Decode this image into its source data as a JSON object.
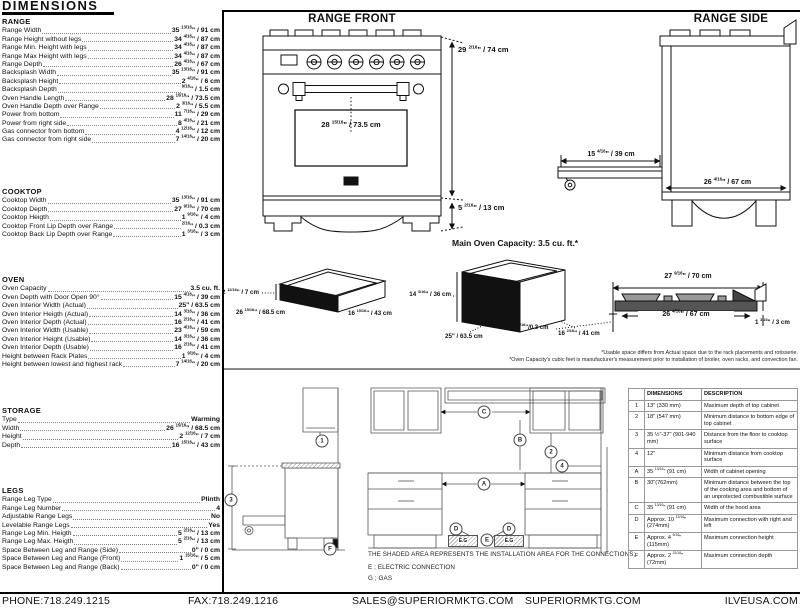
{
  "title": "DIMENSIONS",
  "sections": [
    {
      "id": "range",
      "header": "RANGE",
      "rows": [
        {
          "label": "Range Width",
          "value": "35 13/16\" / 91 cm"
        },
        {
          "label": "Range Height without legs",
          "value": "34 4/16\" / 87 cm"
        },
        {
          "label": "Range Min. Height with legs",
          "value": "34 4/16\" / 87 cm"
        },
        {
          "label": "Range Max Height with legs",
          "value": "34 4/16\" / 87 cm"
        },
        {
          "label": "Range Depth",
          "value": "26 4/16\" / 67 cm"
        },
        {
          "label": "Backsplash Width",
          "value": "35 13/16\" / 91 cm"
        },
        {
          "label": "Backsplash Height",
          "value": "2 4/16\" / 6 cm"
        },
        {
          "label": "Backsplash Depth",
          "value": "9/16\" / 1.5 cm"
        },
        {
          "label": "Oven Handle Length",
          "value": "28 15/16\" / 73.5 cm"
        },
        {
          "label": "Oven Handle Depth over Range",
          "value": "2 3/16\" / 5.5 cm"
        },
        {
          "label": "Power from bottom",
          "value": "11 7/16\" / 29 cm"
        },
        {
          "label": "Power from right side",
          "value": "8 4/16\" / 21 cm"
        },
        {
          "label": "Gas connector from bottom",
          "value": "4 12/16\" / 12 cm"
        },
        {
          "label": "Gas connector from right side",
          "value": "7 14/16\" / 20 cm"
        }
      ]
    },
    {
      "id": "cooktop",
      "header": "COOKTOP",
      "rows": [
        {
          "label": "Cooktop Width",
          "value": "35 13/16\" / 91 cm"
        },
        {
          "label": "Cooktop Depth",
          "value": "27 9/16\" / 70 cm"
        },
        {
          "label": "Cooktop Heigth",
          "value": "1 9/16\" / 4 cm"
        },
        {
          "label": "Cooktop Front Lip Depth over Range",
          "value": "2/16\" / 0.3 cm"
        },
        {
          "label": "Cooktop Back Lip Depth over Range",
          "value": "1 3/16\" / 3 cm"
        }
      ]
    },
    {
      "id": "oven",
      "header": "OVEN",
      "rows": [
        {
          "label": "Oven Capacity",
          "value": "3.5 cu. ft."
        },
        {
          "label": "Oven Depth with Door Open 90°",
          "value": "15 4/16\" / 39 cm"
        },
        {
          "label": "Oven Interior Width (Actual)",
          "value": "25\" / 63.5 cm"
        },
        {
          "label": "Oven Interior Heigth (Actual)",
          "value": "14 3/16\" / 36 cm"
        },
        {
          "label": "Oven Interior Depth (Actual)",
          "value": "16 2/16\" / 41 cm"
        },
        {
          "label": "Oven Interior Width (Usable)",
          "value": "23 4/16\" / 59 cm"
        },
        {
          "label": "Oven Interior Height (Usable)",
          "value": "14 3/16\" / 36 cm"
        },
        {
          "label": "Oven Interior Depth (Usable)",
          "value": "16 2/16\" / 41 cm"
        },
        {
          "label": "Height between Rack Plates",
          "value": "1 9/16\" / 4 cm"
        },
        {
          "label": "Height between lowest and highest rack",
          "value": "7 14/16\" / 20 cm"
        }
      ]
    },
    {
      "id": "storage",
      "header": "STORAGE",
      "rows": [
        {
          "label": "Type",
          "value": "Warming"
        },
        {
          "label": "Width",
          "value": "26 15/16\" / 68.5 cm"
        },
        {
          "label": "Height",
          "value": "2 12/16\" / 7 cm"
        },
        {
          "label": "Depth",
          "value": "16 15/16\" / 43 cm"
        }
      ]
    },
    {
      "id": "legs",
      "header": "LEGS",
      "rows": [
        {
          "label": "Range Leg Type",
          "value": "Plinth"
        },
        {
          "label": "Range Leg Number",
          "value": "4"
        },
        {
          "label": "Adjustable Range Legs",
          "value": "No"
        },
        {
          "label": "Levelable Range Legs",
          "value": "Yes"
        },
        {
          "label": "Range Leg Min. Heigth",
          "value": "5 2/16\" / 13 cm"
        },
        {
          "label": "Range Leg Max. Heigth",
          "value": "5 2/16\" / 13 cm"
        },
        {
          "label": "Space Between Leg and Range (Side)",
          "value": "0\" / 0 cm"
        },
        {
          "label": "Space Between Leg and Range (Front)",
          "value": "1 15/16\" / 5 cm"
        },
        {
          "label": "Space Between Leg and Range (Back)",
          "value": "0\" / 0 cm"
        }
      ]
    }
  ],
  "diagrams": {
    "range_front": {
      "title": "RANGE FRONT",
      "handle_dim": "28 15/16\" / 73.5 cm",
      "height_dim": "29 2/16\" / 74 cm",
      "leg_dim": "5 2/16\" / 13 cm"
    },
    "range_side": {
      "title": "RANGE SIDE",
      "door_dim": "15 4/16\" / 39 cm",
      "depth_dim": "26 4/16\" / 67 cm"
    },
    "capacity_heading": "Main Oven Capacity: 3.5 cu. ft.*",
    "storage_drawer": {
      "height_dim": "2 12/16\" / 7 cm",
      "width_dim": "26 15/16\" / 68.5 cm",
      "depth_dim": "16 15/16\" / 43 cm"
    },
    "oven_interior": {
      "height_dim": "14 3/16\" / 36 cm",
      "width_dim": "25\" / 63.5 cm",
      "depth_dim": "16 2/16\" / 41 cm"
    },
    "cooktop_profile": {
      "top_dim": "27 9/16\" / 70 cm",
      "inner_dim": "26 4/16\" / 67 cm",
      "front_lip_dim": "2/16\"/0.3 cm",
      "back_lip_dim": "1 3/16\" / 3 cm"
    },
    "footnote_usable": "*Usable space differs from Actual space due to the rack placements and rotisserie.",
    "footnote_capacity": "*Oven Capacity's cubic feet is manufacturer's measurement prior to installation of broiler, oven racks, and convection fan."
  },
  "installation": {
    "note": "THE SHADED AREA REPRESENTS THE INSTALLATION AREA FOR THE CONNECTIONS;",
    "legend_electric": "E ; ELECTRIC CONNECTION",
    "legend_gas": "G ; GAS",
    "shaded_box_label": "E.G",
    "markers": [
      {
        "label": "1",
        "x": 322,
        "y": 441
      },
      {
        "label": "3",
        "x": 231,
        "y": 500
      },
      {
        "label": "C",
        "x": 484,
        "y": 412
      },
      {
        "label": "B",
        "x": 520,
        "y": 440
      },
      {
        "label": "2",
        "x": 551,
        "y": 452
      },
      {
        "label": "4",
        "x": 562,
        "y": 466
      },
      {
        "label": "A",
        "x": 484,
        "y": 484
      },
      {
        "label": "D",
        "x": 456,
        "y": 529
      },
      {
        "label": "D",
        "x": 509,
        "y": 529
      },
      {
        "label": "E",
        "x": 487,
        "y": 540
      },
      {
        "label": "F",
        "x": 330,
        "y": 549
      }
    ]
  },
  "spec_table": {
    "headers": [
      "",
      "DIMENSIONS",
      "DESCRIPTION"
    ],
    "rows": [
      [
        "1",
        "13\" (330 mm)",
        "Maximum depth of top cabinet"
      ],
      [
        "2",
        "18\" (547 mm)",
        "Minimum distance to bottom edge of top cabinet"
      ],
      [
        "3",
        "35 ½\"-37\" (901-940 mm)",
        "Distance from the floor to cooktop surface"
      ],
      [
        "4",
        "12\"",
        "Minimum distance from cooktop surface"
      ],
      [
        "A",
        "35 13/16\" (91 cm)",
        "Width of cabinet opening"
      ],
      [
        "B",
        "30\"(762mm)",
        "Minimum distance between the top of the cooking area and bottom of an unprotected combustible surface"
      ],
      [
        "C",
        "35 13/16\" (91 cm)",
        "Width of the hood area"
      ],
      [
        "D",
        "Approx. 10 13/16\" (274mm)",
        "Maximum connection with right and left"
      ],
      [
        "E",
        "Approx. 4 9/16\" (115mm)",
        "Maximum connection height"
      ],
      [
        "F",
        "Approx. 2 13/16\" (72mm)",
        "Maximum connection depth"
      ]
    ]
  },
  "footer": {
    "phone": "PHONE:718.249.1215",
    "fax": "FAX:718.249.1216",
    "email": "SALES@SUPERIORMKTG.COM",
    "site": "SUPERIORMKTG.COM",
    "site2": "ILVEUSA.COM"
  }
}
